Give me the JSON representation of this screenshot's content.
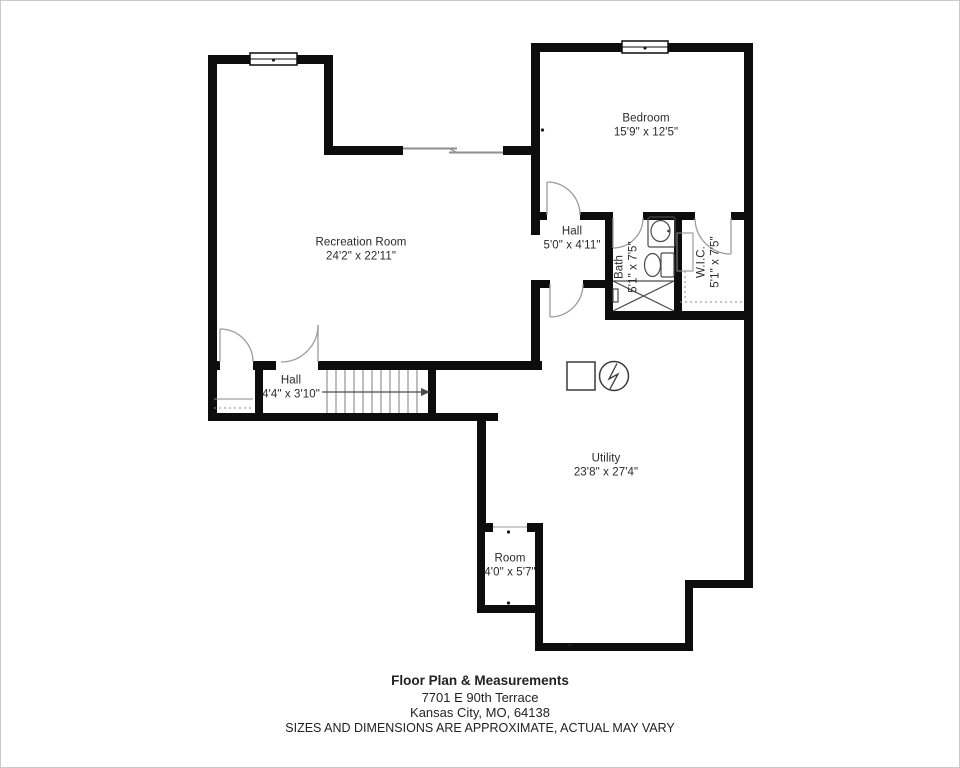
{
  "rooms": {
    "bedroom": {
      "name": "Bedroom",
      "dims": "15'9\" x 12'5\""
    },
    "hall_upper": {
      "name": "Hall",
      "dims": "5'0\" x 4'11\""
    },
    "bath": {
      "name": "Bath",
      "dims": "5'1\" x 7'5\""
    },
    "wic": {
      "name": "W.I.C.",
      "dims": "5'1\" x 7'5\""
    },
    "recreation": {
      "name": "Recreation Room",
      "dims": "24'2\" x 22'11\""
    },
    "hall_lower": {
      "name": "Hall",
      "dims": "4'4\" x 3'10\""
    },
    "utility": {
      "name": "Utility",
      "dims": "23'8\" x 27'4\""
    },
    "room": {
      "name": "Room",
      "dims": "4'0\" x 5'7\""
    }
  },
  "footer": {
    "title": "Floor Plan & Measurements",
    "address_line1": "7701 E 90th Terrace",
    "address_line2": "Kansas City, MO, 64138",
    "disclaimer": "SIZES AND DIMENSIONS ARE APPROXIMATE, ACTUAL MAY VARY"
  },
  "colors": {
    "wall": "#0d0d0d",
    "text": "#2a2a2a",
    "door_arc": "#9b9b9b",
    "fixture": "#4a4a4a",
    "frame_border": "#c9c9c9"
  }
}
